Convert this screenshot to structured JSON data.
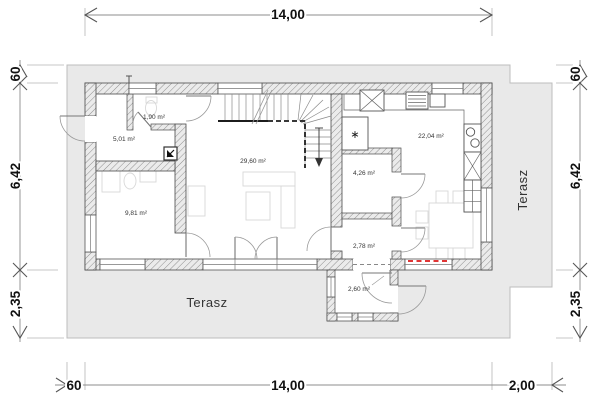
{
  "plan": {
    "dimensions": {
      "top_width": "14,00",
      "bottom_offset_left": "60",
      "bottom_width": "14,00",
      "bottom_offset_right": "2,00",
      "left_offset_top": "60",
      "left_height": "6,42",
      "left_terrace_depth": "2,35",
      "right_offset_top": "60",
      "right_height": "6,42",
      "right_terrace_depth": "2,35"
    },
    "rooms": {
      "wc": "1,90 m²",
      "hall": "5,01 m²",
      "bedroom": "9,81 m²",
      "living": "29,60 m²",
      "kitchen": "22,04 m²",
      "pantry": "4,26 m²",
      "passage": "2,78 m²",
      "entry": "2,60 m²"
    },
    "terrace": {
      "bottom": "Terasz",
      "right": "Terasz"
    },
    "symbols": {
      "chimney": "∗"
    },
    "colors": {
      "terrace_fill": "#e9e9e9",
      "wall_hatch": "#8f8f8f",
      "outline": "#4a4a4a",
      "red_marker": "#e03535"
    }
  }
}
